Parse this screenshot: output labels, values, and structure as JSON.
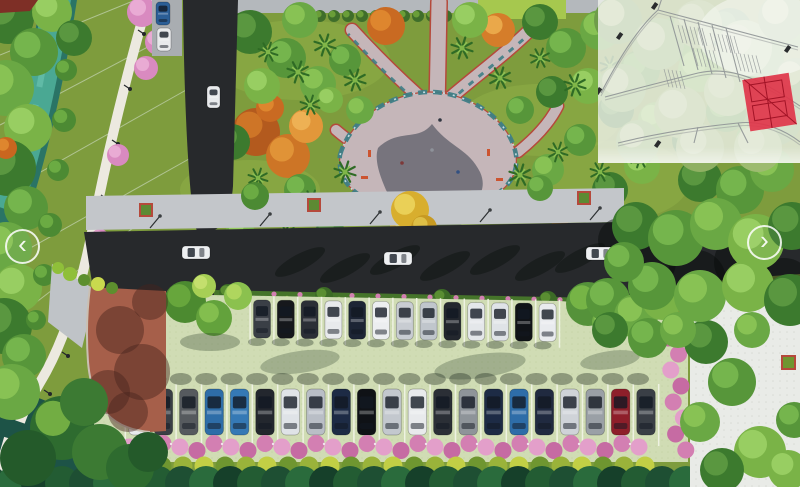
{
  "viewer": {
    "prev_icon": "‹",
    "next_icon": "›"
  },
  "inset": {
    "background": "rgba(240,242,236,0.8)",
    "road_color": "#8f9496",
    "highlight_color": "#e0354a",
    "highlight_detail": "#a21326",
    "marker_color": "#2a2c2e"
  },
  "scene": {
    "colors": {
      "grass": "#7e9c3d",
      "water": "#4aa893",
      "water_edge": "#2a7465",
      "water_dark": "#1d5347",
      "road": "#27292c",
      "sidewalk": "#c3c6ca",
      "parking_surface": "#d0dcb4",
      "terracotta": "#a65f4a",
      "plaza_pavement": "#c5b6b9",
      "path_red_edge": "#b5493b",
      "flower_border_teal": "#3e7e86",
      "pink_flowers": "#d37fb2",
      "yellow_tree": "#cfa92c",
      "orange_tree": "#c96a22",
      "white_path": "#ece9e0",
      "stall_line": "#eef2e2",
      "dark_tree": "#1e4f33",
      "white_plaza": "#e9ebe7",
      "hedge_green": "#45742a"
    },
    "road_cars": [
      {
        "x": 182,
        "y": 246,
        "color": "#eef0f2",
        "orientation": "horizontal"
      },
      {
        "x": 384,
        "y": 252,
        "color": "#eef0f2",
        "orientation": "horizontal"
      },
      {
        "x": 586,
        "y": 247,
        "color": "#eef0f2",
        "orientation": "horizontal"
      },
      {
        "x": 207,
        "y": 86,
        "color": "#e8eaec",
        "orientation": "vertical"
      }
    ],
    "street_parked_cars": [
      {
        "x": 156,
        "y": 2,
        "color": "#2b5e96"
      },
      {
        "x": 157,
        "y": 28,
        "color": "#e8eaec"
      }
    ],
    "parking_lot": {
      "top_row": {
        "start_x": 262,
        "y": 300,
        "spacing": 23.8,
        "car_width": 17,
        "car_height": 38,
        "colors": [
          "#3a3f46",
          "#16181c",
          "#2b2f36",
          "#e8eaec",
          "#1d2535",
          "#eceef0",
          "#c8ccd2",
          "#c0c6cc",
          "#23272e",
          "#e4e7ea",
          "#dfe3e7",
          "#101317",
          "#e9ebee"
        ]
      },
      "bottom_row": {
        "start_x": 138,
        "y": 389,
        "spacing": 25.4,
        "car_width": 18.5,
        "car_height": 46,
        "colors": [
          "#e9ebee",
          "#3a3f46",
          "#565a5e",
          "#2e6da8",
          "#3579b5",
          "#23272e",
          "#dfe3e7",
          "#b9bec6",
          "#1d2b45",
          "#0f1216",
          "#c3c8ce",
          "#e8eaec",
          "#2b2f36",
          "#8e9499",
          "#1d2b45",
          "#2e6da8",
          "#202a40",
          "#cfd3d8",
          "#9aa0a6",
          "#8e1f2a",
          "#3a3f46"
        ]
      }
    }
  }
}
